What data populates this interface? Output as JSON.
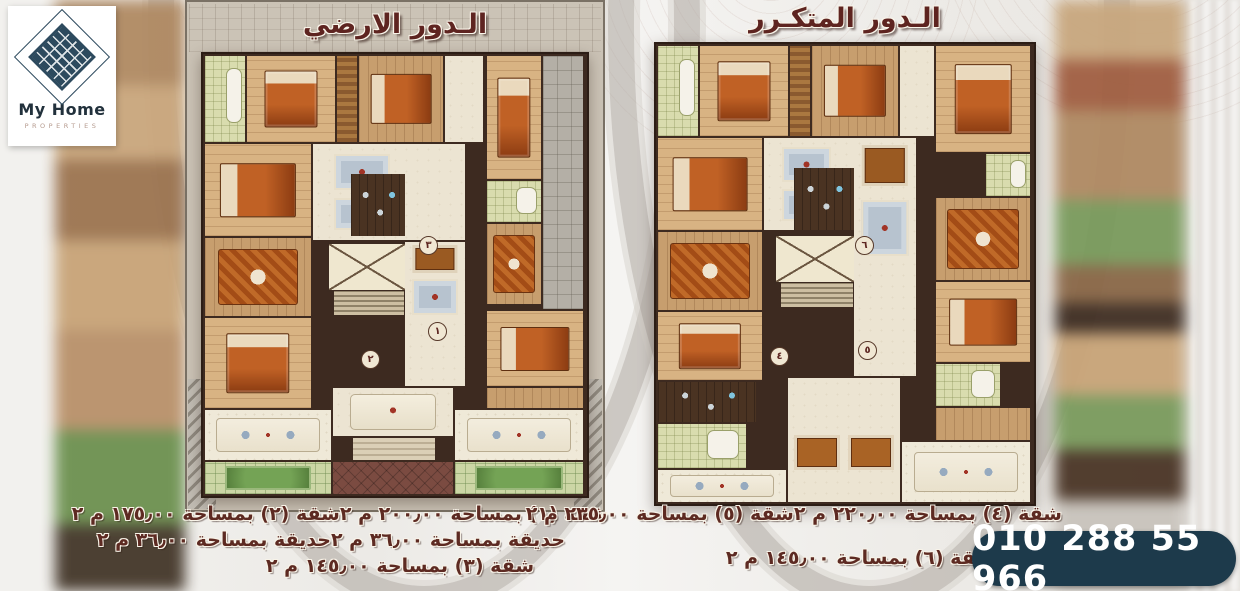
{
  "logo": {
    "title": "My Home",
    "subtitle": "Properties"
  },
  "plans": {
    "left": {
      "title": "الـدور الارضي",
      "badges": [
        "١",
        "٢",
        "٣"
      ]
    },
    "right": {
      "title": "الـدور المتكـرر",
      "badges": [
        "٤",
        "٥",
        "٦"
      ]
    }
  },
  "footer": {
    "left": {
      "line1_right": "شقة (١) بمساحة ٢٠٠٫٠٠ م ٢",
      "line1_left": "شقة (٢) بمساحة ١٧٥٫٠٠ م ٢",
      "line2_right": "حديقة بمساحة ٣٦٫٠٠ م ٢",
      "line2_left": "حديقة بمساحة ٣٦٫٠٠ م ٢",
      "line3": "شقة (٣) بمساحة ١٤٥٫٠٠ م ٢"
    },
    "right": {
      "line1_right": "شقة (٤) بمساحة ٢٢٠٫٠٠ م ٢",
      "line1_left": "شقة (٥) بمساحة ٢٣٥٫٠٠ م ٢",
      "line2": "شقة (٦) بمساحة ١٤٥٫٠٠ م ٢"
    }
  },
  "contact": {
    "phone": "010 288 55 966"
  },
  "colors": {
    "wall": "#3d2a20",
    "marble": "#ece4d2",
    "wood": "#d8b383",
    "bath": "#d9dcae",
    "garden": "#74a355",
    "accent_text": "#5d2a22",
    "phone_banner": "#1d3a4b"
  }
}
